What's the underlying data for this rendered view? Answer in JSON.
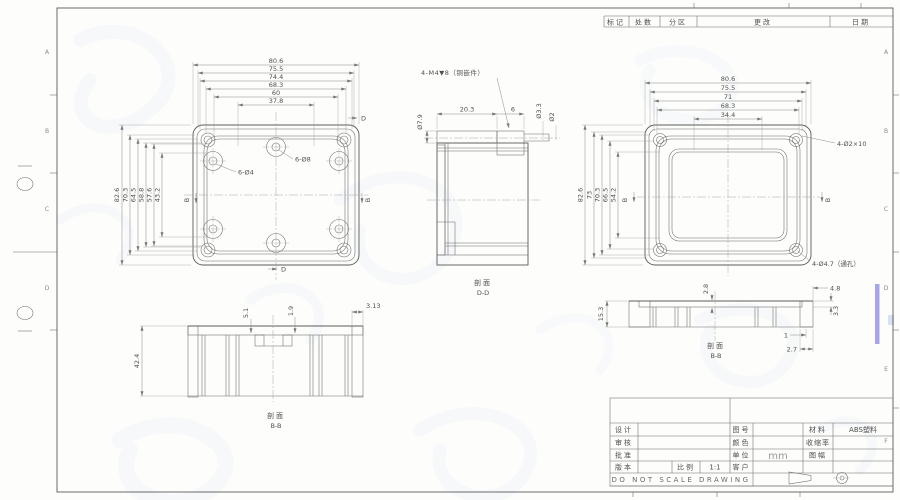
{
  "revision_table": {
    "columns": [
      "标记",
      "处数",
      "分区",
      "更改",
      "日期"
    ]
  },
  "zones": {
    "left": [
      "A",
      "B",
      "C",
      "D"
    ],
    "right": [
      "A",
      "B",
      "C",
      "D",
      "E",
      "F"
    ]
  },
  "views": {
    "left": {
      "dims_top": [
        "80.6",
        "75.5",
        "74.4",
        "68.3",
        "60",
        "37.8"
      ],
      "dims_left": [
        "82.6",
        "70.3",
        "64.5",
        "58.8",
        "57.6",
        "43.2"
      ],
      "small_holes": "6-Ø4",
      "large_holes": "6-Ø8",
      "b": "B",
      "d": "D"
    },
    "mid": {
      "callout": "4-M4▼8（铜嵌件）",
      "dim_w": "20.3",
      "dim_boss": "6",
      "dim_d79": "Ø7.9",
      "dim_d33": "Ø3.3",
      "dim_d2": "Ø2",
      "sec": "剖面",
      "sec_name": "D-D"
    },
    "right": {
      "dims_top": [
        "80.6",
        "75.5",
        "71",
        "68.3",
        "34.4"
      ],
      "dims_left": [
        "82.6",
        "73",
        "70.3",
        "66.5",
        "54.2"
      ],
      "callout_top": "4-Ø2×10",
      "callout_bot": "4-Ø4.7（通孔）",
      "b": "B"
    },
    "bl": {
      "d51": "5.1",
      "d19": "1.9",
      "d313": "3.13",
      "d424": "42.4",
      "sec": "剖面",
      "sec_name": "B-B"
    },
    "br": {
      "d48": "4.8",
      "d28": "2.8",
      "d153": "15.3",
      "d33": "3.3",
      "d1": "1",
      "d27": "2.7",
      "sec": "剖面",
      "sec_name": "B-B"
    }
  },
  "title_block": {
    "design_label": "设计",
    "check_label": "审核",
    "approve_label": "批准",
    "version_label": "版本",
    "drawing_no_label": "图号",
    "color_label": "颜色",
    "unit_label": "单位",
    "customer_label": "客户",
    "material_label": "材料",
    "shrinkage_label": "收缩率",
    "sheet_label": "图幅",
    "scale_label": "比例",
    "material_value": "ABS塑料",
    "unit_value": "mm",
    "scale_value": "1:1",
    "note": "DO NOT SCALE DRAWING"
  }
}
